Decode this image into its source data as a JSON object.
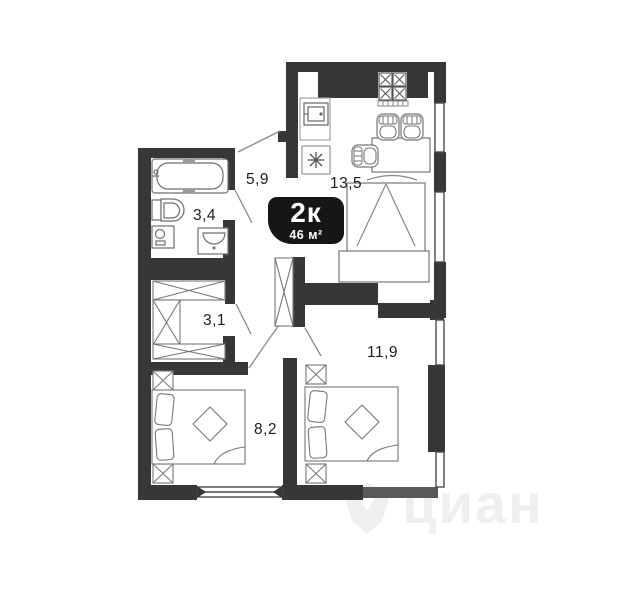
{
  "floorplan": {
    "badge": {
      "rooms_type": "2к",
      "area": "46 м²"
    },
    "room_labels": {
      "hallway": "5,9",
      "kitchen_living": "13,5",
      "bathroom": "3,4",
      "closet": "3,1",
      "bedroom_left": "8,2",
      "bedroom_right": "11,9"
    },
    "watermark": "циан",
    "colors": {
      "wall": "#373737",
      "parapet": "#595959",
      "furniture_line": "#777777",
      "badge_bg": "#161616",
      "badge_text": "#ffffff",
      "watermark": "#f0eff0"
    }
  }
}
